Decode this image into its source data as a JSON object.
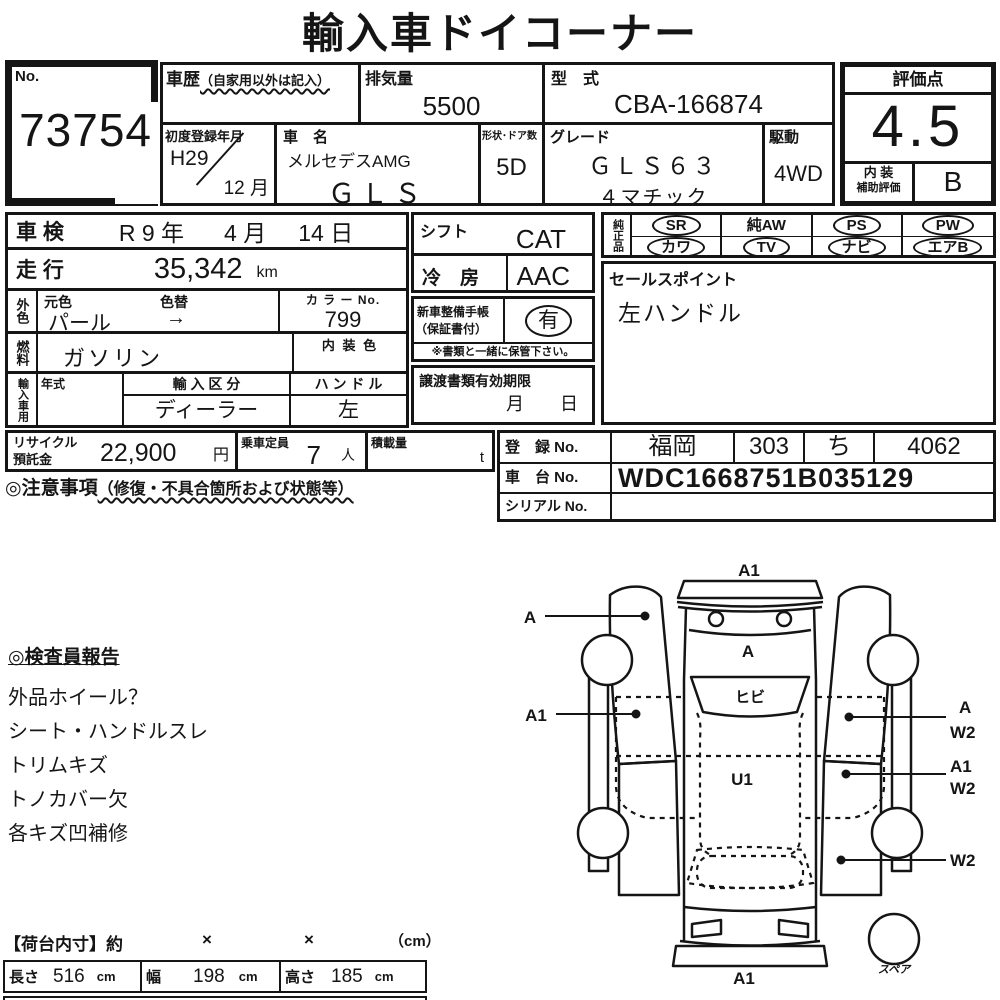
{
  "title": "輸入車ドイコーナー",
  "header": {
    "no_label": "No.",
    "no_value": "73754",
    "history_label": "車歴",
    "history_note": "（自家用以外は記入）",
    "displacement_label": "排気量",
    "displacement_value": "5500",
    "model_code_label": "型　式",
    "model_code_value": "CBA-166874",
    "first_reg_label": "初度登録年月",
    "first_reg_year": "H29",
    "first_reg_month": "12 月",
    "car_name_label": "車　名",
    "car_name_brand": "メルセデスAMG",
    "car_name_model": "ＧＬＳ",
    "doors_label": "形状･ドア数",
    "doors_value": "5D",
    "grade_label": "グレード",
    "grade_line1": "ＧＬＳ６３",
    "grade_line2": "４マチック",
    "drive_label": "駆動",
    "drive_value": "4WD",
    "score_label": "評価点",
    "score_value": "4.5",
    "interior_label1": "内 装",
    "interior_label2": "補助評価",
    "interior_value": "B"
  },
  "left_table": {
    "shaken_label": "車 検",
    "shaken_year": "R 9 年",
    "shaken_month": "4 月",
    "shaken_day": "14 日",
    "mileage_label": "走 行",
    "mileage_value": "35,342",
    "mileage_unit": "km",
    "ext_color_label": "外色",
    "base_color_label": "元色",
    "color_change_label": "色替",
    "base_color_value": "パール",
    "color_change_value": "→",
    "color_no_label": "カ ラ ー No.",
    "color_no_value": "799",
    "fuel_label": "燃料",
    "fuel_value": "ガソリン",
    "interior_color_label": "内 装 色",
    "import_label": "輸入車用",
    "model_year_label": "年式",
    "import_type_label": "輸 入 区 分",
    "import_type_value": "ディーラー",
    "handle_label": "ハ ン ド ル",
    "handle_value": "左"
  },
  "middle_table": {
    "shift_label": "シフト",
    "shift_value": "CAT",
    "ac_label": "冷　房",
    "ac_value": "AAC",
    "maintenance_label1": "新車整備手帳",
    "maintenance_label2": "（保証書付）",
    "maintenance_value": "有",
    "maintenance_note": "※書類と一緒に保管下さい。",
    "transfer_label": "譲渡書類有効期限",
    "transfer_month": "月",
    "transfer_day": "日"
  },
  "genuine": {
    "label": "純正品",
    "items": [
      {
        "label": "SR",
        "circled": true
      },
      {
        "label": "純AW",
        "circled": false
      },
      {
        "label": "PS",
        "circled": true
      },
      {
        "label": "PW",
        "circled": true
      },
      {
        "label": "カワ",
        "circled": true
      },
      {
        "label": "TV",
        "circled": true
      },
      {
        "label": "ナビ",
        "circled": true
      },
      {
        "label": "エアB",
        "circled": true
      }
    ]
  },
  "sales_point": {
    "label": "セールスポイント",
    "value": "左ハンドル"
  },
  "recycle": {
    "label1": "リサイクル",
    "label2": "預託金",
    "value": "22,900",
    "unit": "円",
    "capacity_label": "乗車定員",
    "capacity_value": "7",
    "capacity_unit": "人",
    "load_label": "積載量",
    "load_unit": "t"
  },
  "registration": {
    "reg_label": "登　録 No.",
    "reg_region": "福岡",
    "reg_class": "303",
    "reg_kana": "ち",
    "reg_number": "4062",
    "chassis_label": "車　台 No.",
    "chassis_value": "WDC1668751B035129",
    "serial_label": "シリアル No.",
    "serial_value": ""
  },
  "caution": {
    "heading": "◎注意事項",
    "heading_note": "（修復・不具合箇所および状態等）"
  },
  "inspector": {
    "heading": "◎検査員報告",
    "items": [
      "外品ホイール？",
      "シート・ハンドルスレ",
      "トリムキズ",
      "トノカバー欠",
      "各キズ凹補修"
    ]
  },
  "diagram": {
    "front_label": "A1",
    "left_fender_label": "A",
    "hood_label": "A",
    "windshield_label": "ヒビ",
    "left_door_label": "A1",
    "right_front_labels": [
      "A",
      "W2"
    ],
    "roof_label": "U1",
    "right_rear_labels": [
      "A1",
      "W2"
    ],
    "right_quarter_label": "W2",
    "rear_label": "A1",
    "spare_label": "スペア"
  },
  "cargo": {
    "heading": "【荷台内寸】約",
    "x1": "×",
    "x2": "×",
    "unit_note": "（cm）",
    "length_label": "長さ",
    "length_value": "516",
    "length_unit": "cm",
    "width_label": "幅",
    "width_value": "198",
    "width_unit": "cm",
    "height_label": "高さ",
    "height_value": "185",
    "height_unit": "cm"
  }
}
